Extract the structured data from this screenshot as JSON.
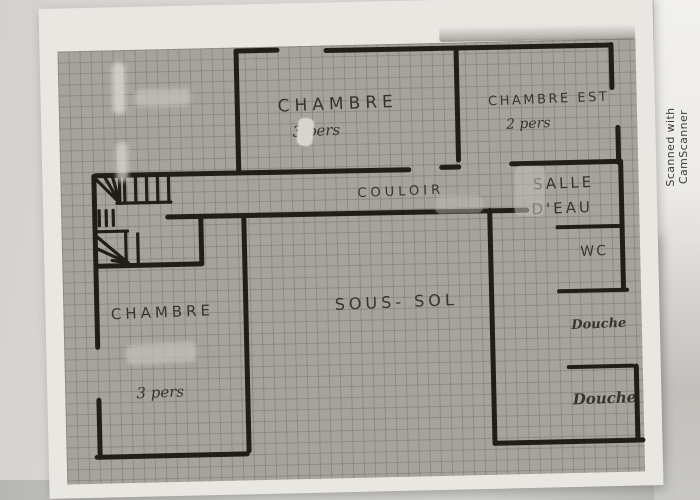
{
  "watermark": "Scanned with CamScanner",
  "plan": {
    "rooms": {
      "chambre_nord": {
        "name": "CHAMBRE",
        "capacity": "3 pers"
      },
      "chambre_est": {
        "name": "CHAMBRE EST",
        "capacity": "2 pers"
      },
      "couloir": {
        "name": "COULOIR"
      },
      "salle_eau": {
        "name_line1": "SALLE",
        "name_line2": "D'EAU"
      },
      "wc": {
        "name": "WC"
      },
      "sous_sol": {
        "name": "SOUS- SOL"
      },
      "chambre_ouest": {
        "name": "CHAMBRE",
        "capacity": "3 pers"
      },
      "douche_haut": {
        "name": "Douche"
      },
      "douche_bas": {
        "name": "Douche"
      }
    },
    "colors": {
      "wall_ink": "#211e19",
      "pencil": "#37342e",
      "grid_paper": "#a6a39d",
      "grid_line": "#8f8c86",
      "paper_margin": "#e9e7e2"
    }
  }
}
